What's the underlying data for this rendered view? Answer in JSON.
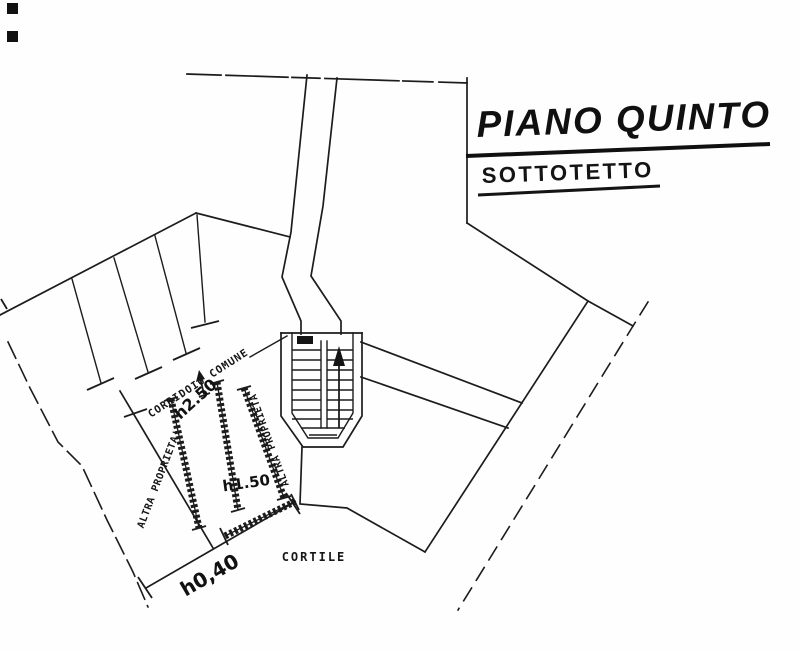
{
  "drawing": {
    "title": "PIANO QUINTO",
    "subtitle": "SOTTOTETTO",
    "labels": {
      "corridor": "CORRIDOIO COMUNE",
      "other_property_left": "ALTRA PROPRIETA'",
      "other_property_right": "ALTRA PROPRIETA'",
      "courtyard": "CORTILE"
    },
    "dimensions": {
      "corridor_height": "h2.50",
      "room_height": "h1.50",
      "low_wall_height": "h0,40"
    },
    "colors": {
      "ink": "#1c1c1c",
      "paper": "#fefefe"
    }
  }
}
